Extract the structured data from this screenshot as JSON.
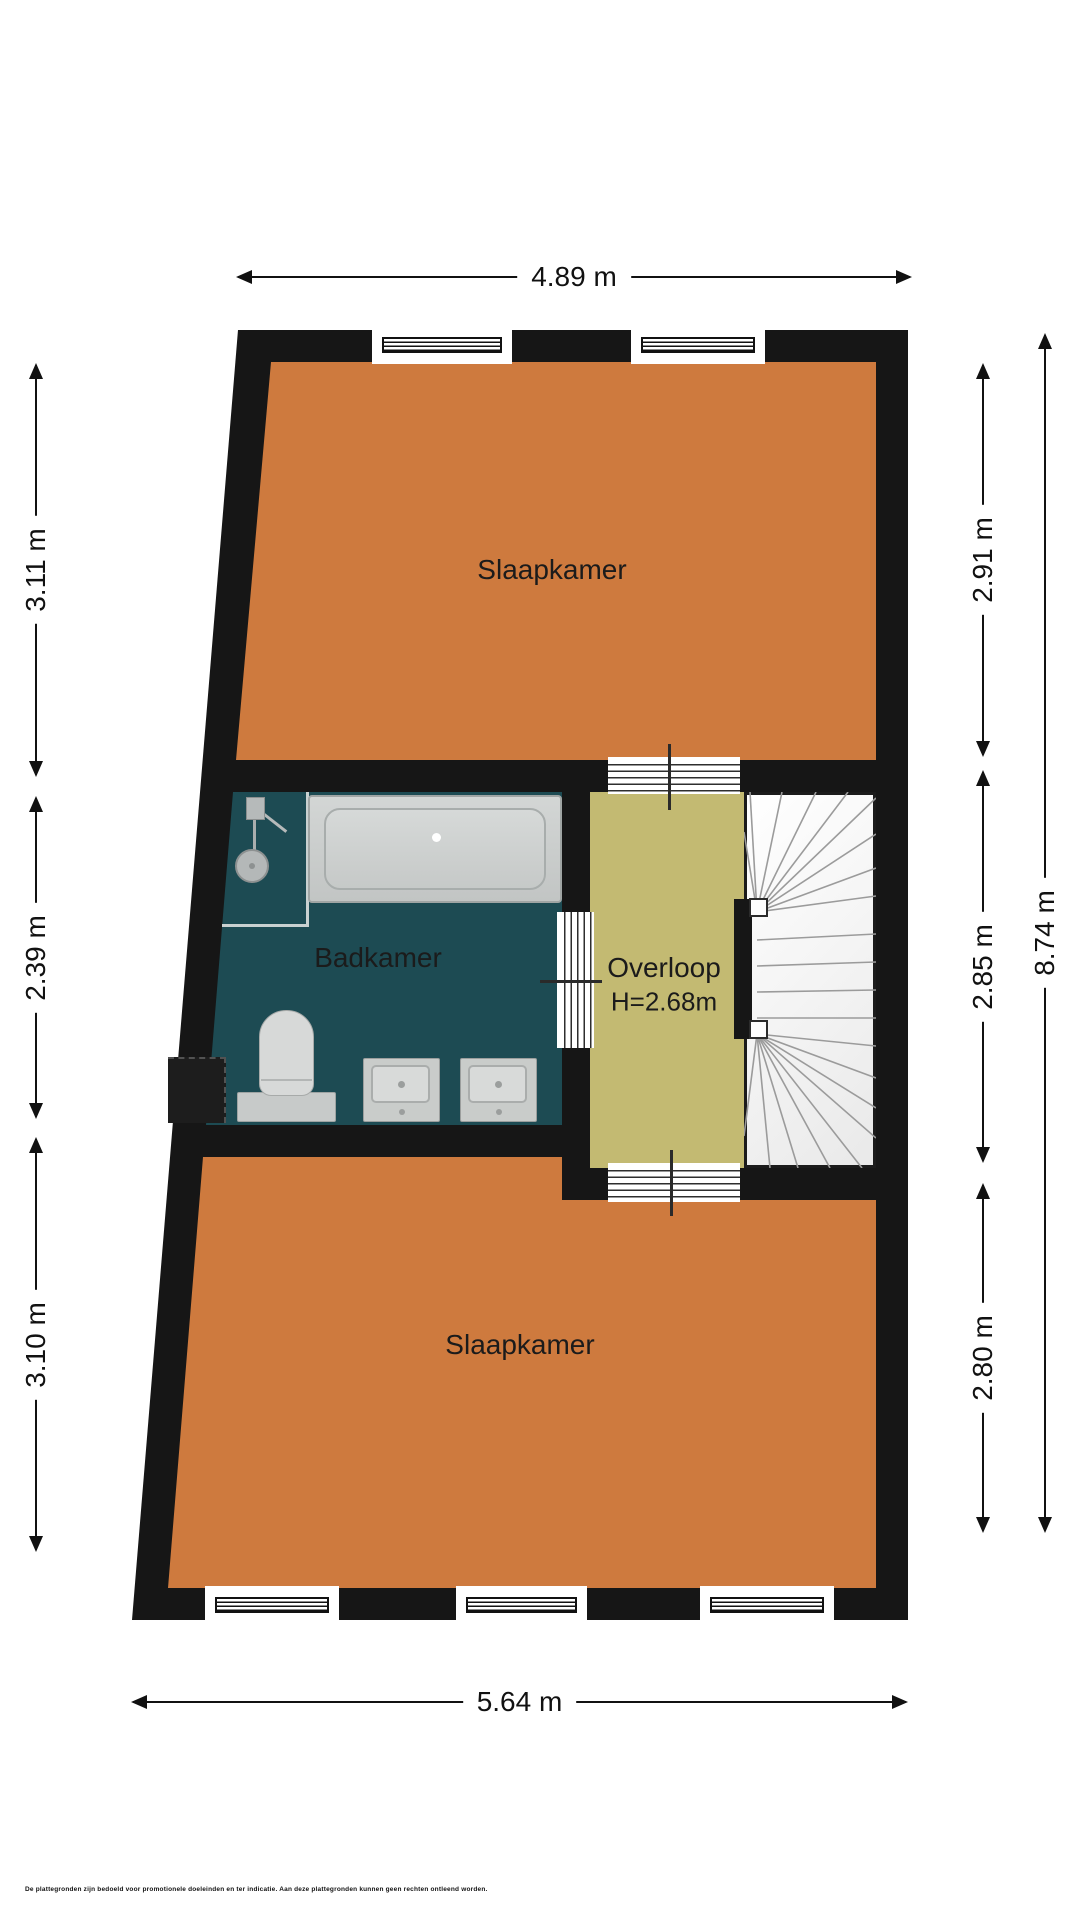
{
  "plan": {
    "rooms": {
      "bedroom_top": {
        "label": "Slaapkamer"
      },
      "bathroom": {
        "label": "Badkamer"
      },
      "landing": {
        "label": "Overloop",
        "height": "H=2.68m"
      },
      "bedroom_bottom": {
        "label": "Slaapkamer"
      }
    },
    "dimensions": {
      "top": "4.89 m",
      "bottom": "5.64 m",
      "left": [
        "3.11 m",
        "2.39 m",
        "3.10 m"
      ],
      "right_inner": [
        "2.91 m",
        "2.85 m",
        "2.80 m"
      ],
      "right_overall": "8.74 m"
    },
    "colors": {
      "wall": "#161616",
      "bedroom": "#ce7a3e",
      "bathroom": "#1d4b53",
      "landing": "#c3ba72"
    },
    "disclaimer": "De plattegronden zijn bedoeld voor promotionele doeleinden en ter indicatie. Aan deze plattegronden kunnen geen rechten ontleend worden."
  }
}
